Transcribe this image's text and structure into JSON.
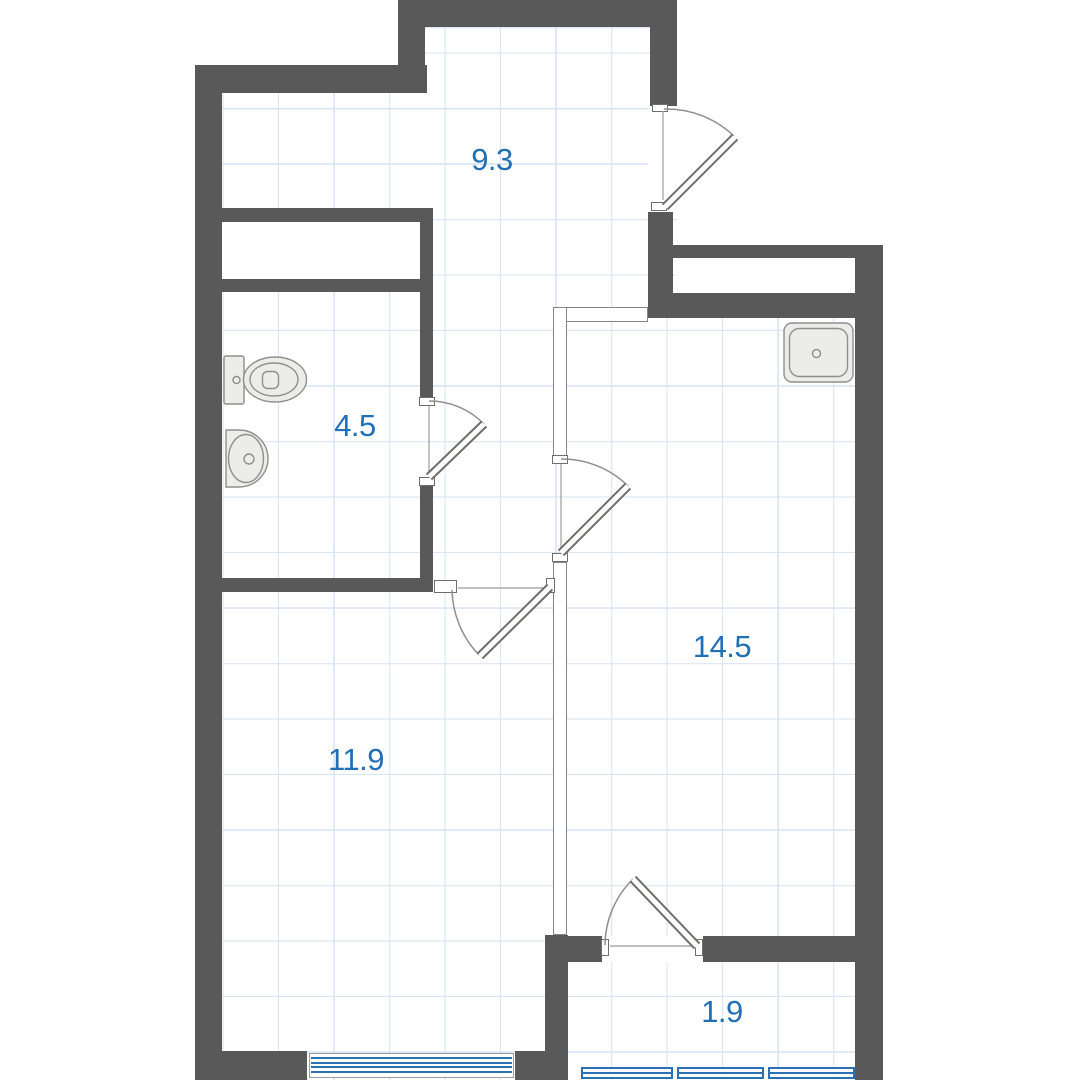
{
  "plan_title": "apartment-floor-plan",
  "rooms": [
    {
      "id": "hallway",
      "label": "9.3"
    },
    {
      "id": "bathroom",
      "label": "4.5"
    },
    {
      "id": "kitchen-living-room",
      "label": "14.5"
    },
    {
      "id": "bedroom",
      "label": "11.9"
    },
    {
      "id": "balcony",
      "label": "1.9"
    }
  ],
  "fixtures": [
    {
      "icon": "toilet-icon"
    },
    {
      "icon": "washbasin-icon"
    },
    {
      "icon": "kitchen-sink-icon"
    }
  ],
  "colors": {
    "wall": "#595959",
    "room_label": "#2070b8",
    "window": "#2b6fb4",
    "grid_line": "#d7e4f4",
    "fixture_fill": "#ecece9"
  }
}
